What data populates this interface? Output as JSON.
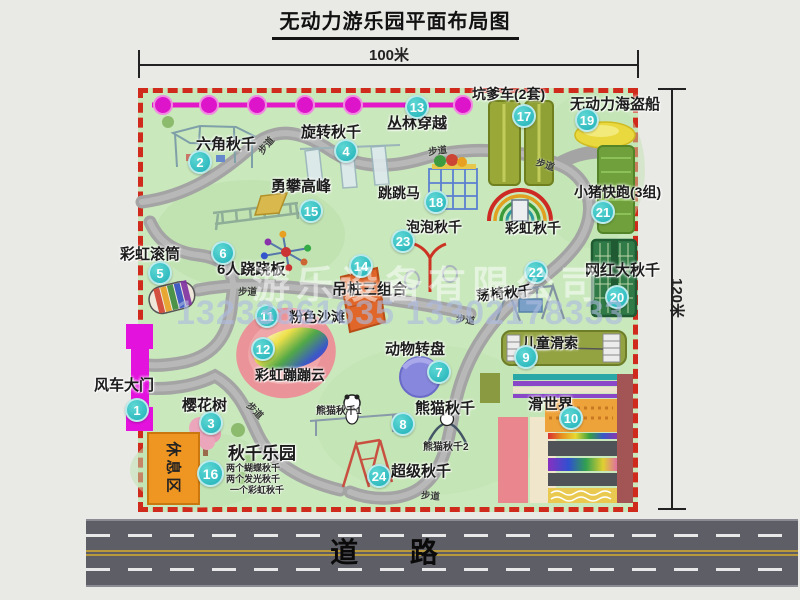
{
  "title": "无动力游乐园平面布局图",
  "dim_width": "100米",
  "dim_height": "120米",
  "road_label": "道 路",
  "path_label": "步道",
  "rest_area": "休息区",
  "extra": {
    "rainbow_swing": "彩虹秋千"
  },
  "watermark": {
    "company": "游乐设备有限公司",
    "phone": "13233861635 13302178333"
  },
  "notes": {
    "panda1": "熊猫秋千1",
    "panda2": "熊猫秋千2",
    "swing1": "两个蝴蝶秋千",
    "swing2": "两个发光秋千",
    "swing3": "一个彩虹秋千"
  },
  "attractions": [
    {
      "num": "1",
      "name": "风车大门"
    },
    {
      "num": "2",
      "name": "六角秋千"
    },
    {
      "num": "3",
      "name": "樱花树"
    },
    {
      "num": "4",
      "name": "旋转秋千"
    },
    {
      "num": "5",
      "name": "彩虹滚筒"
    },
    {
      "num": "6",
      "name": "6人跷跷板"
    },
    {
      "num": "7",
      "name": "动物转盘"
    },
    {
      "num": "8",
      "name": "熊猫秋千"
    },
    {
      "num": "9",
      "name": "儿童滑索"
    },
    {
      "num": "10",
      "name": "滑世界"
    },
    {
      "num": "11",
      "name": "粉色沙滩"
    },
    {
      "num": "12",
      "name": "彩虹蹦蹦云"
    },
    {
      "num": "13",
      "name": "丛林穿越"
    },
    {
      "num": "14",
      "name": "吊桩三组合"
    },
    {
      "num": "15",
      "name": "勇攀高峰"
    },
    {
      "num": "16",
      "name": "秋千乐园"
    },
    {
      "num": "17",
      "name": "坑爹车(2套)"
    },
    {
      "num": "18",
      "name": "跳跳马"
    },
    {
      "num": "19",
      "name": "无动力海盗船"
    },
    {
      "num": "20",
      "name": "网红大秋千"
    },
    {
      "num": "21",
      "name": "小猪快跑(3组)"
    },
    {
      "num": "22",
      "name": "荡椅秋千"
    },
    {
      "num": "23",
      "name": "泡泡秋千"
    },
    {
      "num": "24",
      "name": "超级秋千"
    }
  ]
}
